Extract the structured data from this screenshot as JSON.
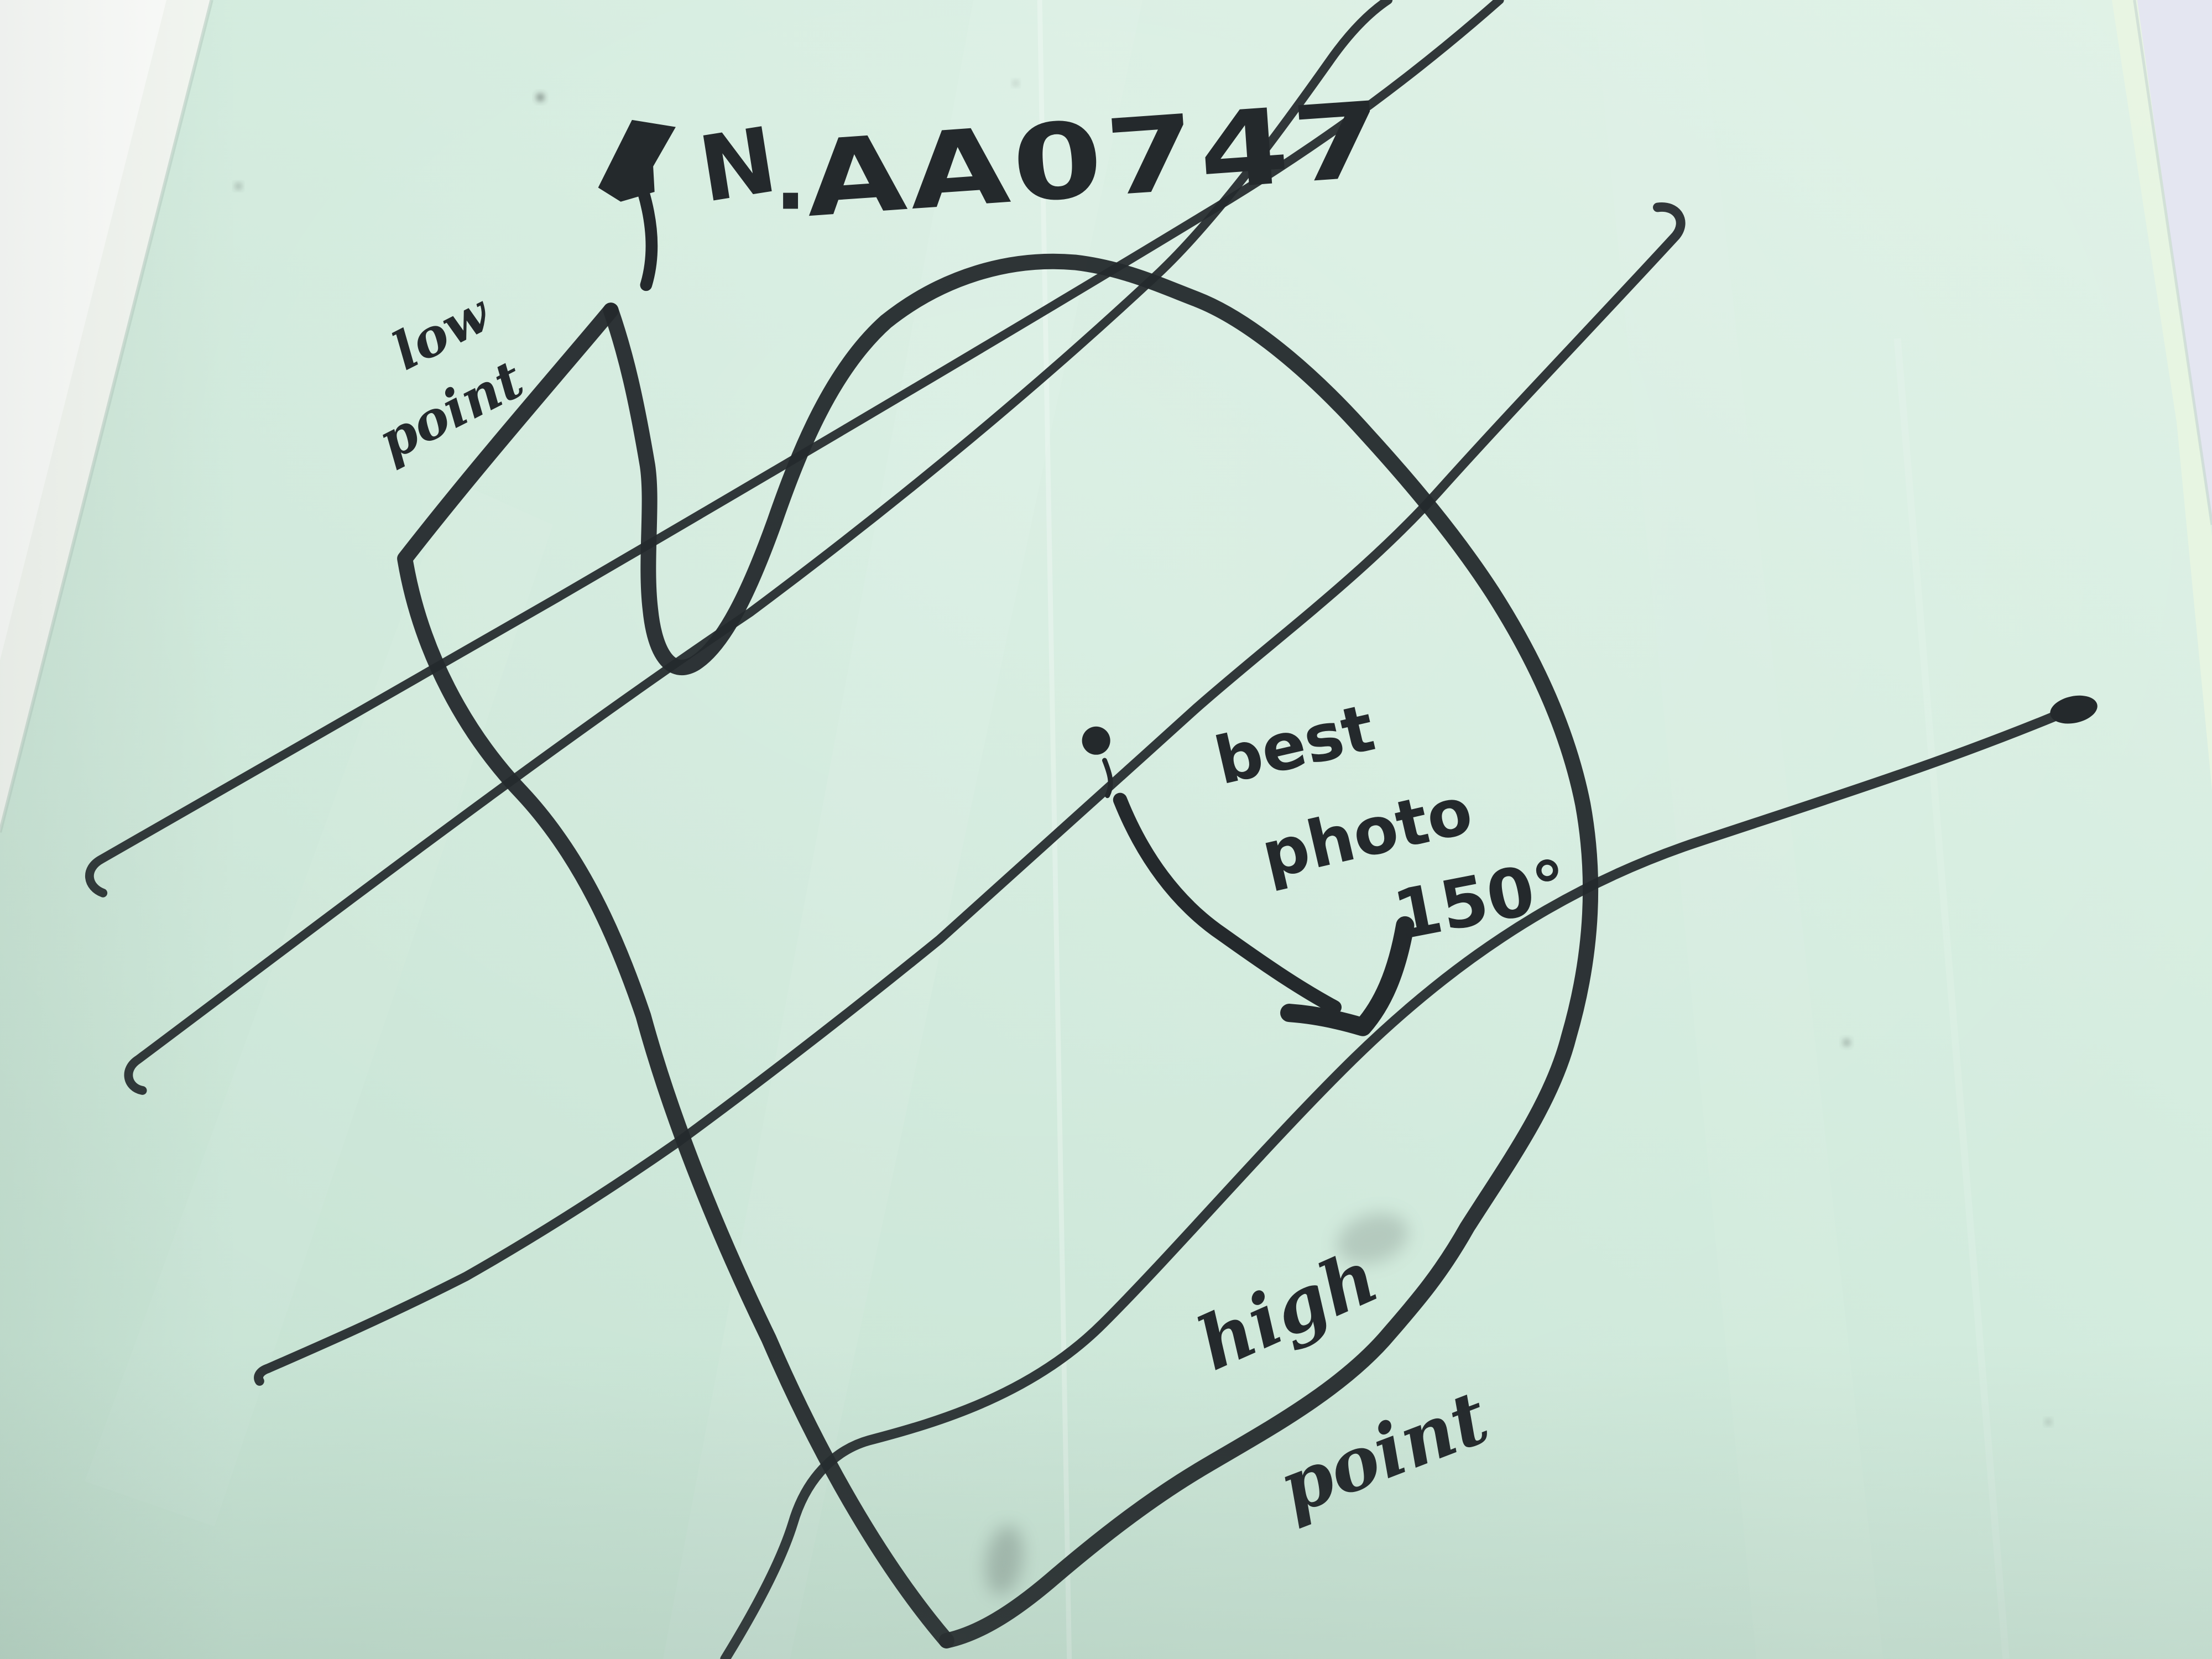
{
  "title": {
    "north_label": "N",
    "separator": ".",
    "site_code": "AA0747"
  },
  "annotations": {
    "low_point": {
      "line1": "low",
      "line2": "point"
    },
    "best_photo": {
      "line1": "best",
      "line2": "photo",
      "bearing": "150°"
    },
    "high_point": {
      "line1": "high",
      "line2": "point"
    }
  },
  "icons": {
    "north_arrow": "north-arrow-icon",
    "photo_direction_arrow": "photo-direction-arrow-icon",
    "best_photo_marker": "location-dot-icon"
  },
  "colors": {
    "paper": "#d2ebdd",
    "paper_light": "#e0f2e7",
    "paper_dark": "#c5e2d2",
    "ink": "#24292c",
    "background_white": "#f3f6f1",
    "background_lavender": "#e4e6f1"
  }
}
